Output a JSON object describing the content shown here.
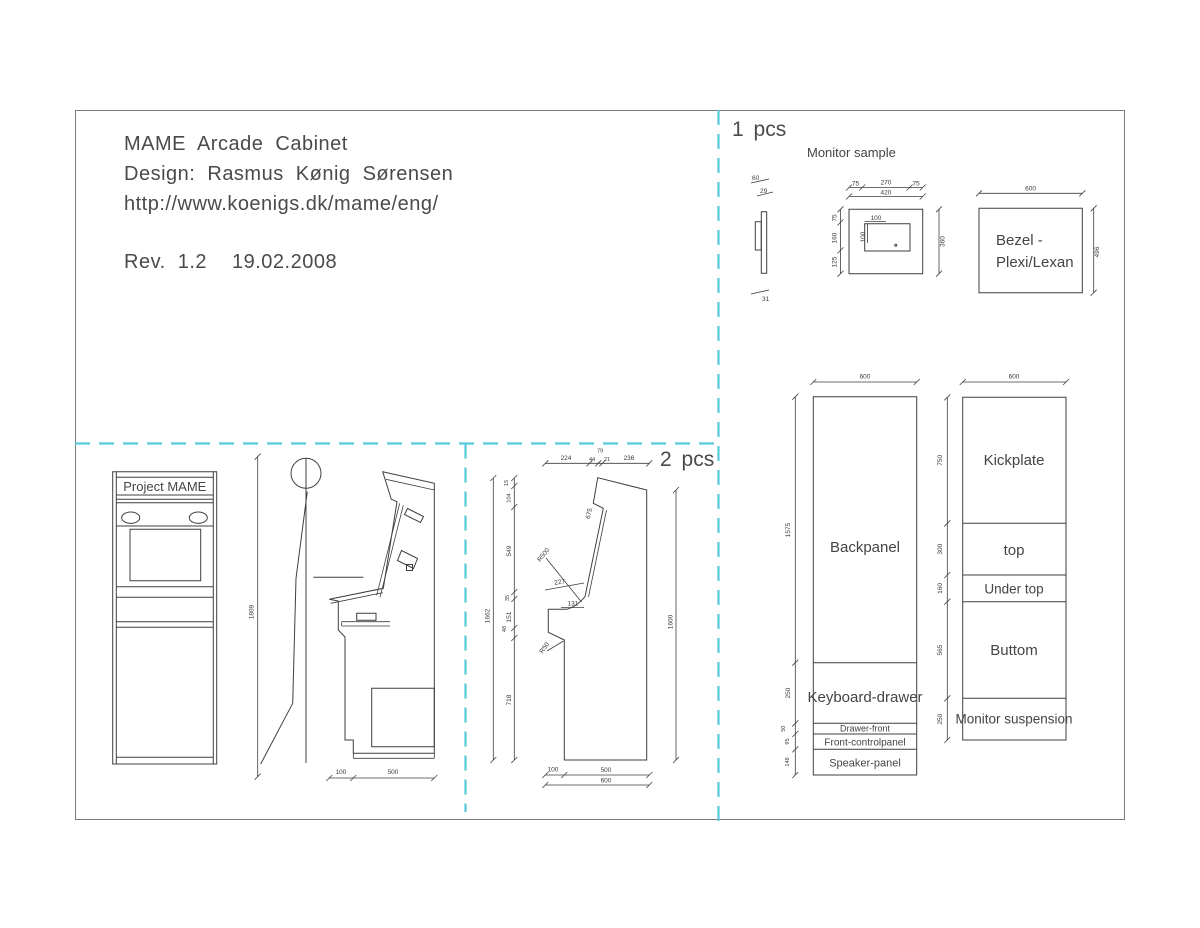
{
  "colors": {
    "cut_line_accent": "#56c9da",
    "drawing_line": "#3f3f3f",
    "text": "#3a3a3a"
  },
  "title_block": {
    "line1": "MAME Arcade Cabinet",
    "line2": "Design: Rasmus Kønig Sørensen",
    "line3": "http://www.koenigs.dk/mame/eng/",
    "rev": "Rev. 1.2",
    "date": "19.02.2008"
  },
  "sections": {
    "one_pcs": "1 pcs",
    "two_pcs": "2 pcs"
  },
  "monitor_sample": {
    "label": "Monitor sample",
    "side_dims": [
      "60",
      "29",
      "31"
    ],
    "front_dims": {
      "top": [
        "75",
        "270",
        "75"
      ],
      "total_width": "420",
      "left": [
        "75",
        "160",
        "125"
      ],
      "right": "360",
      "inner": [
        "100",
        "100"
      ]
    },
    "bezel": {
      "label_line1": "Bezel -",
      "label_line2": "Plexi/Lexan",
      "width": "600",
      "height": "496"
    }
  },
  "front_view": {
    "marquee": "Project MAME",
    "overall_height": "1809",
    "bottom_dims": [
      "100",
      "500"
    ]
  },
  "side_panel": {
    "top_dims": [
      "224",
      "44",
      "79",
      "21",
      "236"
    ],
    "left_outer": "1662",
    "left_dims": [
      "15",
      "104",
      "549",
      "35",
      "151",
      "48",
      "718"
    ],
    "right_dim": "1600",
    "bottom_dims": [
      "100",
      "500",
      "600"
    ],
    "slope_dim": "675",
    "radius_large": "R500",
    "cp_dim": "227",
    "notch_dim": "131",
    "radius_small": "R50"
  },
  "panels_a": {
    "width": "600",
    "rows": [
      {
        "label": "Backpanel",
        "dim": "1575"
      },
      {
        "label": "Keyboard-drawer",
        "dim": "250"
      },
      {
        "label": "Drawer-front",
        "dim": "50"
      },
      {
        "label": "Front-controlpanel",
        "dim": "95"
      },
      {
        "label": "Speaker-panel",
        "dim": "148"
      }
    ]
  },
  "panels_b": {
    "width": "600",
    "rows": [
      {
        "label": "Kickplate",
        "dim": "750"
      },
      {
        "label": "top",
        "dim": "300"
      },
      {
        "label": "Under top",
        "dim": "160"
      },
      {
        "label": "Buttom",
        "dim": "565"
      },
      {
        "label": "Monitor suspension",
        "dim": "250"
      }
    ]
  }
}
